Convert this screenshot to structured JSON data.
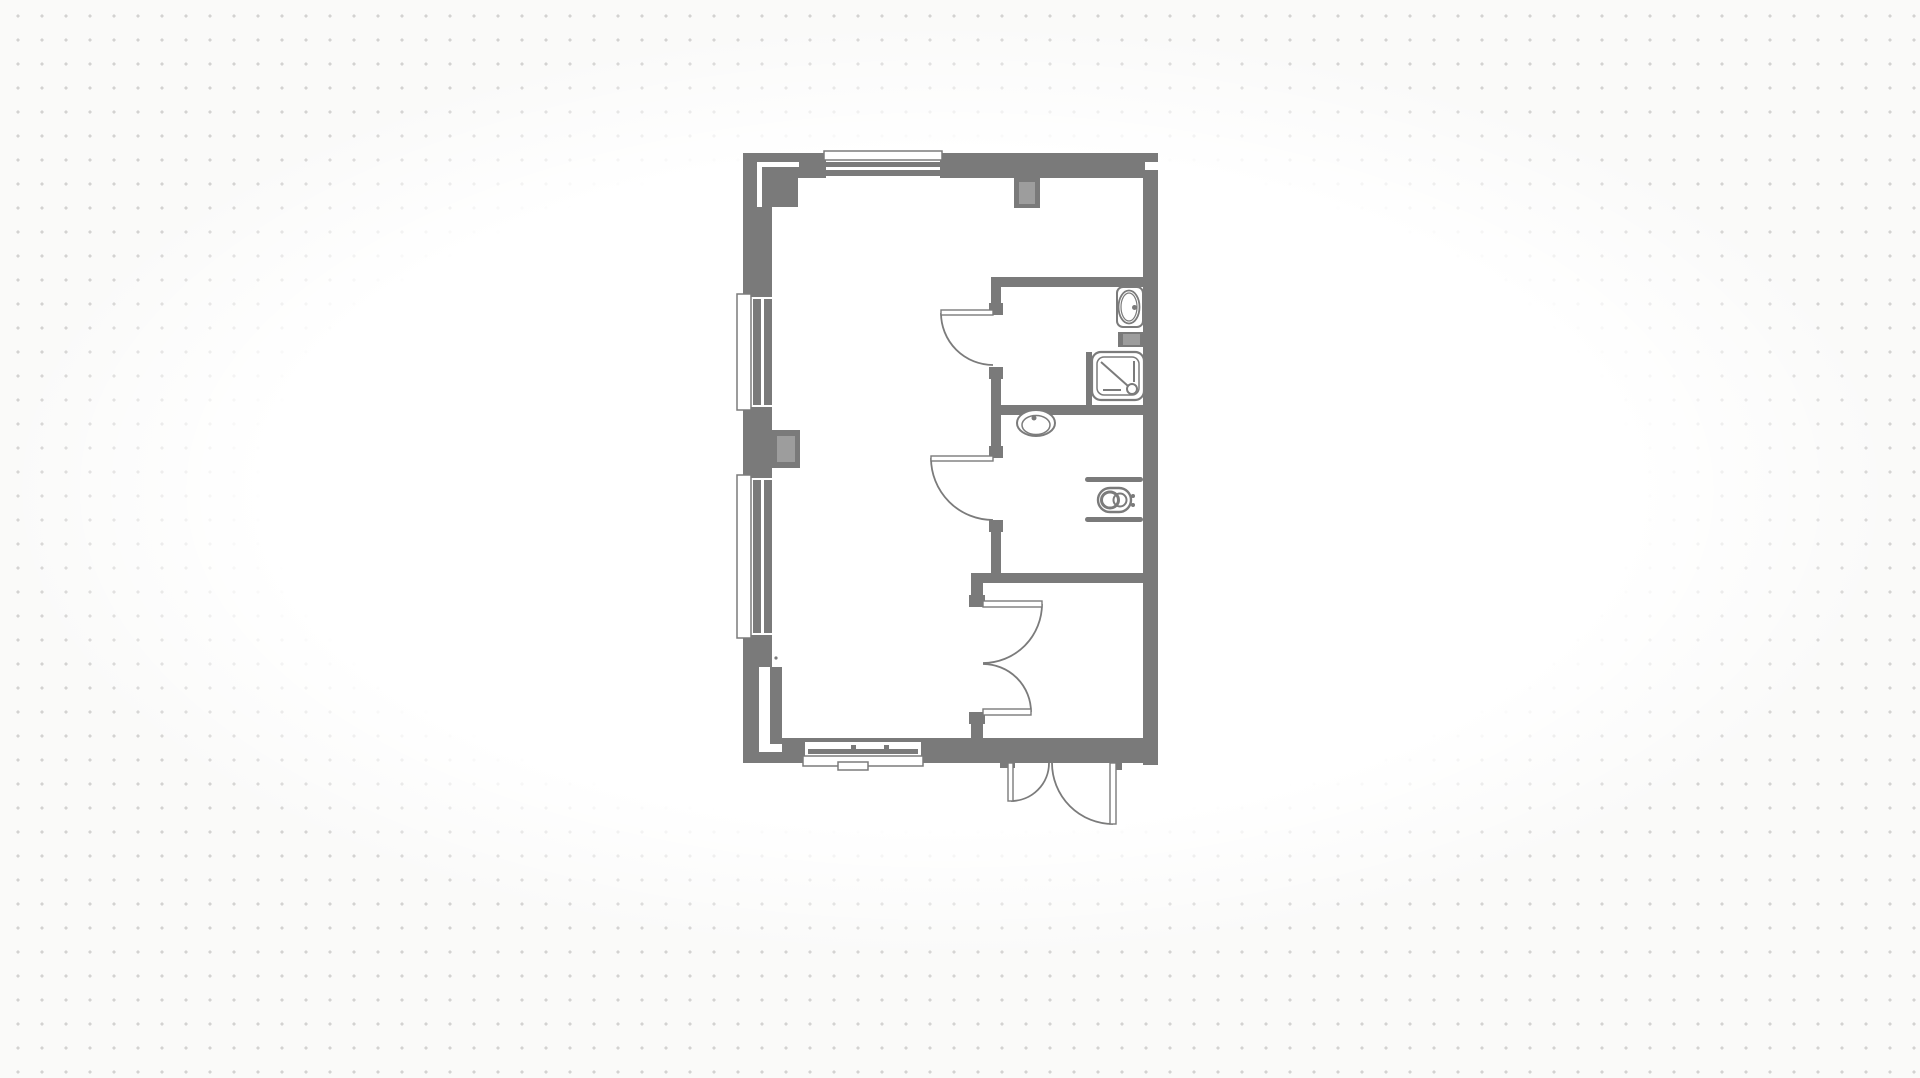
{
  "canvas": {
    "width": 1920,
    "height": 1078,
    "background_color": "#fafaf9",
    "grid": {
      "style": "dot",
      "spacing_px": 24,
      "dot_size_px": 3,
      "dot_color": "#d3d2d1"
    },
    "vignette_color": "#ffffff",
    "palette": {
      "wall": "#7a7a7a",
      "line": "#7b7b7b",
      "duct": "#9d9d9d",
      "white": "#ffffff"
    }
  },
  "floorplan": {
    "description": "studio-flat-floor-plan",
    "rooms": [
      "living-area",
      "shower-room",
      "wc-room",
      "entry-hall"
    ],
    "objects": [
      {
        "name": "floor-area",
        "interactable": true,
        "shapes": [
          {
            "t": "rect",
            "x": 743,
            "y": 153,
            "w": 415,
            "h": 612,
            "f": "white"
          }
        ]
      },
      {
        "name": "wall-exterior-top",
        "interactable": true,
        "shapes": [
          {
            "t": "rect",
            "x": 743,
            "y": 153,
            "w": 415,
            "h": 25,
            "f": "wall"
          }
        ]
      },
      {
        "name": "wall-exterior-left",
        "interactable": true,
        "shapes": [
          {
            "t": "rect",
            "x": 743,
            "y": 153,
            "w": 29,
            "h": 610,
            "f": "wall"
          }
        ]
      },
      {
        "name": "wall-exterior-right",
        "interactable": true,
        "shapes": [
          {
            "t": "rect",
            "x": 1143,
            "y": 153,
            "w": 15,
            "h": 612,
            "f": "wall"
          }
        ]
      },
      {
        "name": "wall-exterior-bottom",
        "interactable": true,
        "shapes": [
          {
            "t": "rect",
            "x": 743,
            "y": 738,
            "w": 415,
            "h": 25,
            "f": "wall"
          }
        ]
      },
      {
        "name": "pier-top-left-corner",
        "interactable": true,
        "shapes": [
          {
            "t": "rect",
            "x": 757,
            "y": 162,
            "w": 5,
            "h": 45,
            "f": "white"
          },
          {
            "t": "rect",
            "x": 757,
            "y": 162,
            "w": 42,
            "h": 5,
            "f": "white"
          },
          {
            "t": "rect",
            "x": 763,
            "y": 170,
            "w": 35,
            "h": 37,
            "f": "wall"
          }
        ]
      },
      {
        "name": "window-top",
        "interactable": true,
        "shapes": [
          {
            "t": "rect",
            "x": 826,
            "y": 153,
            "w": 114,
            "h": 25,
            "f": "white"
          },
          {
            "t": "rect",
            "x": 824,
            "y": 151,
            "w": 118,
            "h": 9,
            "f": "white",
            "s": "line",
            "sw": 1.5
          },
          {
            "t": "rect",
            "x": 826,
            "y": 162,
            "w": 114,
            "h": 5,
            "f": "wall"
          },
          {
            "t": "rect",
            "x": 826,
            "y": 170,
            "w": 114,
            "h": 6,
            "f": "wall"
          }
        ]
      },
      {
        "name": "window-left-upper",
        "interactable": true,
        "shapes": [
          {
            "t": "rect",
            "x": 743,
            "y": 297,
            "w": 29,
            "h": 110,
            "f": "white"
          },
          {
            "t": "rect",
            "x": 737,
            "y": 294,
            "w": 14,
            "h": 116,
            "f": "white",
            "s": "line",
            "sw": 1.5
          },
          {
            "t": "rect",
            "x": 753,
            "y": 299,
            "w": 8,
            "h": 106,
            "f": "wall"
          },
          {
            "t": "rect",
            "x": 764,
            "y": 299,
            "w": 8,
            "h": 106,
            "f": "wall"
          }
        ]
      },
      {
        "name": "window-left-lower",
        "interactable": true,
        "shapes": [
          {
            "t": "rect",
            "x": 743,
            "y": 478,
            "w": 29,
            "h": 157,
            "f": "white"
          },
          {
            "t": "rect",
            "x": 737,
            "y": 475,
            "w": 14,
            "h": 163,
            "f": "white",
            "s": "line",
            "sw": 1.5
          },
          {
            "t": "rect",
            "x": 753,
            "y": 480,
            "w": 8,
            "h": 153,
            "f": "wall"
          },
          {
            "t": "rect",
            "x": 764,
            "y": 480,
            "w": 8,
            "h": 153,
            "f": "wall"
          }
        ]
      },
      {
        "name": "pier-mid-left",
        "interactable": true,
        "shapes": [
          {
            "t": "rect",
            "x": 772,
            "y": 430,
            "w": 28,
            "h": 38,
            "f": "wall"
          },
          {
            "t": "rect",
            "x": 777,
            "y": 436,
            "w": 18,
            "h": 26,
            "f": "duct"
          }
        ]
      },
      {
        "name": "pilaster-bottom-left",
        "interactable": true,
        "shapes": [
          {
            "t": "rect",
            "x": 759,
            "y": 667,
            "w": 11,
            "h": 85,
            "f": "white"
          },
          {
            "t": "rect",
            "x": 759,
            "y": 744,
            "w": 23,
            "h": 8,
            "f": "white"
          },
          {
            "t": "rect",
            "x": 770,
            "y": 667,
            "w": 12,
            "h": 77,
            "f": "wall"
          },
          {
            "t": "circle",
            "cx": 776,
            "cy": 658,
            "r": 1.6,
            "f": "wall"
          }
        ]
      },
      {
        "name": "window-bottom",
        "interactable": true,
        "shapes": [
          {
            "t": "rect",
            "x": 805,
            "y": 742,
            "w": 116,
            "h": 21,
            "f": "white"
          },
          {
            "t": "rect",
            "x": 808,
            "y": 749,
            "w": 110,
            "h": 5,
            "f": "wall"
          },
          {
            "t": "rect",
            "x": 851,
            "y": 745,
            "w": 5,
            "h": 4,
            "f": "wall"
          },
          {
            "t": "rect",
            "x": 884,
            "y": 745,
            "w": 5,
            "h": 4,
            "f": "wall"
          },
          {
            "t": "rect",
            "x": 803,
            "y": 756,
            "w": 120,
            "h": 10,
            "f": "white",
            "s": "line",
            "sw": 1.5
          },
          {
            "t": "rect",
            "x": 838,
            "y": 762,
            "w": 30,
            "h": 8,
            "f": "white",
            "s": "line",
            "sw": 1.5
          }
        ]
      },
      {
        "name": "flue-top-wall",
        "interactable": true,
        "shapes": [
          {
            "t": "rect",
            "x": 1014,
            "y": 178,
            "w": 26,
            "h": 30,
            "f": "wall"
          },
          {
            "t": "rect",
            "x": 1019,
            "y": 182,
            "w": 16,
            "h": 22,
            "f": "duct"
          }
        ]
      },
      {
        "name": "notch-right-wall-top",
        "interactable": false,
        "shapes": [
          {
            "t": "rect",
            "x": 1145,
            "y": 162,
            "w": 13,
            "h": 8,
            "f": "white"
          }
        ]
      },
      {
        "name": "wall-interior-bathrooms-west",
        "interactable": true,
        "shapes": [
          {
            "t": "rect",
            "x": 991,
            "y": 277,
            "w": 10,
            "h": 38,
            "f": "wall"
          },
          {
            "t": "rect",
            "x": 991,
            "y": 367,
            "w": 10,
            "h": 91,
            "f": "wall"
          },
          {
            "t": "rect",
            "x": 991,
            "y": 520,
            "w": 10,
            "h": 63,
            "f": "wall"
          },
          {
            "t": "rect",
            "x": 989,
            "y": 303,
            "w": 14,
            "h": 12,
            "f": "wall"
          },
          {
            "t": "rect",
            "x": 989,
            "y": 367,
            "w": 14,
            "h": 12,
            "f": "wall"
          },
          {
            "t": "rect",
            "x": 989,
            "y": 446,
            "w": 14,
            "h": 12,
            "f": "wall"
          },
          {
            "t": "rect",
            "x": 989,
            "y": 520,
            "w": 14,
            "h": 12,
            "f": "wall"
          }
        ]
      },
      {
        "name": "wall-interior-shower-room-north",
        "interactable": true,
        "shapes": [
          {
            "t": "rect",
            "x": 991,
            "y": 277,
            "w": 152,
            "h": 10,
            "f": "wall"
          }
        ]
      },
      {
        "name": "wall-interior-between-bathrooms",
        "interactable": true,
        "shapes": [
          {
            "t": "rect",
            "x": 991,
            "y": 405,
            "w": 152,
            "h": 10,
            "f": "wall"
          }
        ]
      },
      {
        "name": "wall-interior-entry-north",
        "interactable": true,
        "shapes": [
          {
            "t": "rect",
            "x": 971,
            "y": 573,
            "w": 172,
            "h": 10,
            "f": "wall"
          }
        ]
      },
      {
        "name": "wall-interior-entry-west",
        "interactable": true,
        "shapes": [
          {
            "t": "rect",
            "x": 971,
            "y": 583,
            "w": 12,
            "h": 24,
            "f": "wall"
          },
          {
            "t": "rect",
            "x": 971,
            "y": 712,
            "w": 12,
            "h": 26,
            "f": "wall"
          },
          {
            "t": "rect",
            "x": 969,
            "y": 595,
            "w": 16,
            "h": 12,
            "f": "wall"
          },
          {
            "t": "rect",
            "x": 969,
            "y": 712,
            "w": 16,
            "h": 12,
            "f": "wall"
          }
        ]
      },
      {
        "name": "duct-shower-room",
        "interactable": true,
        "shapes": [
          {
            "t": "rect",
            "x": 1118,
            "y": 332,
            "w": 27,
            "h": 15,
            "f": "wall"
          },
          {
            "t": "rect",
            "x": 1123,
            "y": 334,
            "w": 17,
            "h": 11,
            "f": "duct"
          }
        ]
      },
      {
        "name": "toilet",
        "interactable": true,
        "shapes": [
          {
            "t": "rect",
            "x": 1117,
            "y": 287,
            "w": 26,
            "h": 40,
            "rx": 6,
            "f": "white",
            "s": "line",
            "sw": 2
          },
          {
            "t": "ellipse",
            "cx": 1129,
            "cy": 307,
            "rx": 10.5,
            "ry": 16.5,
            "f": "white",
            "s": "line",
            "sw": 1.8
          },
          {
            "t": "ellipse",
            "cx": 1129,
            "cy": 307,
            "rx": 8,
            "ry": 14,
            "f": "none",
            "s": "line",
            "sw": 1.2
          },
          {
            "t": "circle",
            "cx": 1134.5,
            "cy": 307.5,
            "r": 2.5,
            "f": "wall"
          }
        ]
      },
      {
        "name": "shower",
        "interactable": true,
        "shapes": [
          {
            "t": "rect",
            "x": 1086,
            "y": 352,
            "w": 6,
            "h": 53,
            "f": "wall"
          },
          {
            "t": "rect",
            "x": 1092,
            "y": 352,
            "w": 52,
            "h": 48,
            "rx": 9,
            "f": "white",
            "s": "line",
            "sw": 2.2
          },
          {
            "t": "rect",
            "x": 1097,
            "y": 357,
            "w": 42,
            "h": 38,
            "rx": 7,
            "f": "none",
            "s": "line",
            "sw": 1.5
          },
          {
            "t": "line",
            "x1": 1101,
            "y1": 362,
            "x2": 1128,
            "y2": 386,
            "s": "line",
            "sw": 2
          },
          {
            "t": "line",
            "x1": 1134,
            "y1": 361,
            "x2": 1134,
            "y2": 382,
            "s": "line",
            "sw": 2
          },
          {
            "t": "line",
            "x1": 1103,
            "y1": 390,
            "x2": 1121,
            "y2": 390,
            "s": "line",
            "sw": 2
          },
          {
            "t": "circle",
            "cx": 1132,
            "cy": 389,
            "r": 5,
            "f": "white",
            "s": "line",
            "sw": 2
          }
        ]
      },
      {
        "name": "basin",
        "interactable": true,
        "shapes": [
          {
            "t": "ellipse",
            "cx": 1036,
            "cy": 423,
            "rx": 19,
            "ry": 13,
            "f": "white",
            "s": "line",
            "sw": 2
          },
          {
            "t": "ellipse",
            "cx": 1036,
            "cy": 425,
            "rx": 14,
            "ry": 9.5,
            "f": "none",
            "s": "line",
            "sw": 1.5
          },
          {
            "t": "circle",
            "cx": 1034,
            "cy": 418,
            "r": 2.5,
            "f": "wall"
          }
        ]
      },
      {
        "name": "wall-hung-wc",
        "interactable": true,
        "shapes": [
          {
            "t": "rect",
            "x": 1085,
            "y": 477,
            "w": 58,
            "h": 5,
            "rx": 2.5,
            "f": "wall"
          },
          {
            "t": "rect",
            "x": 1085,
            "y": 517,
            "w": 58,
            "h": 5,
            "rx": 2.5,
            "f": "wall"
          },
          {
            "t": "rect",
            "x": 1098,
            "y": 488,
            "w": 33,
            "h": 24,
            "rx": 12,
            "f": "white",
            "s": "line",
            "sw": 2.4
          },
          {
            "t": "ellipse",
            "cx": 1110,
            "cy": 500,
            "rx": 8.5,
            "ry": 8,
            "f": "none",
            "s": "line",
            "sw": 3
          },
          {
            "t": "circle",
            "cx": 1120,
            "cy": 500,
            "r": 6.5,
            "f": "none",
            "s": "line",
            "sw": 2
          },
          {
            "t": "circle",
            "cx": 1133,
            "cy": 496,
            "r": 2,
            "f": "wall"
          },
          {
            "t": "circle",
            "cx": 1133,
            "cy": 505,
            "r": 2,
            "f": "wall"
          }
        ]
      },
      {
        "name": "door-shower-room",
        "interactable": true,
        "shapes": [
          {
            "t": "path",
            "d": "M941,313 A52,52 0 0 0 993,365",
            "f": "none",
            "s": "line",
            "sw": 1.8
          },
          {
            "t": "rect",
            "x": 941,
            "y": 310,
            "w": 52,
            "h": 5,
            "f": "white",
            "s": "line",
            "sw": 1.4
          }
        ]
      },
      {
        "name": "door-wc-room",
        "interactable": true,
        "shapes": [
          {
            "t": "path",
            "d": "M931,458 A62,62 0 0 0 993,520",
            "f": "none",
            "s": "line",
            "sw": 1.8
          },
          {
            "t": "rect",
            "x": 931,
            "y": 456,
            "w": 62,
            "h": 5,
            "f": "white",
            "s": "line",
            "sw": 1.4
          }
        ]
      },
      {
        "name": "double-door-entry-hall",
        "interactable": true,
        "shapes": [
          {
            "t": "path",
            "d": "M1042,604 A59,59 0 0 1 983,663",
            "f": "none",
            "s": "line",
            "sw": 1.8
          },
          {
            "t": "rect",
            "x": 983,
            "y": 601,
            "w": 59,
            "h": 6,
            "f": "white",
            "s": "line",
            "sw": 1.4
          },
          {
            "t": "path",
            "d": "M1031,712 A48,48 0 0 0 983,664",
            "f": "none",
            "s": "line",
            "sw": 1.8
          },
          {
            "t": "rect",
            "x": 983,
            "y": 709,
            "w": 48,
            "h": 6,
            "f": "white",
            "s": "line",
            "sw": 1.4
          }
        ]
      },
      {
        "name": "entry-door-double-leaf",
        "interactable": true,
        "shapes": [
          {
            "t": "rect",
            "x": 1003,
            "y": 763,
            "w": 122,
            "h": 66,
            "f": "white"
          },
          {
            "t": "rect",
            "x": 1000,
            "y": 763,
            "w": 15,
            "h": 5,
            "f": "wall"
          },
          {
            "t": "rect",
            "x": 1110,
            "y": 763,
            "w": 12,
            "h": 7,
            "f": "wall"
          },
          {
            "t": "path",
            "d": "M1011,801 A38,38 0 0 0 1049,763",
            "f": "none",
            "s": "line",
            "sw": 1.8
          },
          {
            "t": "rect",
            "x": 1008,
            "y": 763,
            "w": 5,
            "h": 38,
            "f": "white",
            "s": "line",
            "sw": 1.4
          },
          {
            "t": "path",
            "d": "M1113,824 A61,61 0 0 1 1052,763",
            "f": "none",
            "s": "line",
            "sw": 1.8
          },
          {
            "t": "rect",
            "x": 1110,
            "y": 763,
            "w": 6,
            "h": 61,
            "f": "white",
            "s": "line",
            "sw": 1.4
          }
        ]
      }
    ]
  }
}
